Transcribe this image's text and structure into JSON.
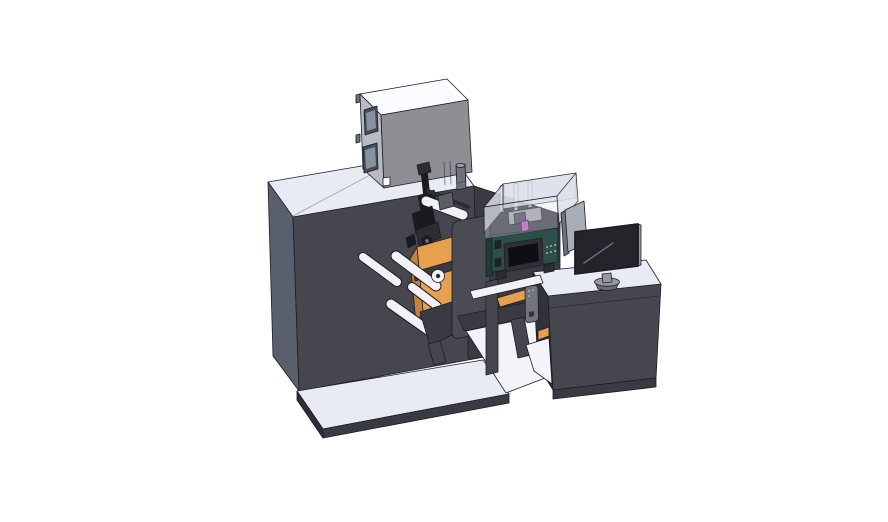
{
  "meta": {
    "alt": "Isometric 3D CAD rendering of an industrial roll-fed label printing machine: a large dark charcoal cabinet on a white base plate with a gray top enclosure box, an orange unwind arm with white guide rollers and black print mechanism, a dark front cover plate, a teal inkjet print module with a small touchscreen under a clear media enclosure, a transfer bridge, and an operator desk with a monitor on top.",
    "canvas": {
      "width": 888,
      "height": 522
    }
  },
  "colors": {
    "background": "#ffffff",
    "surface_light": "#e8eaf4",
    "floor_white": "#f3f4f9",
    "surface_white": "#fafbfe",
    "cabinet_front": "#46464e",
    "cabinet_side": "#5a5f6d",
    "cabinet_dark": "#3a3a42",
    "base_edge_dark": "#2e2e36",
    "desk_side": "#32323a",
    "box_front": "#8e8e93",
    "box_side": "#b8bbc3",
    "window_frame": "#454c59",
    "window_glass": "#8792a1",
    "plate_gray": "#4b4b53",
    "bracket_gray": "#71737d",
    "metal_mid": "#6e707a",
    "metal_light": "#9aa0ab",
    "roller_white": "#f2f2f6",
    "mech_black": "#1b1b1f",
    "mech_dark2": "#2c2c33",
    "mech_gray": "#5c5e66",
    "accent_orange": "#e6a04e",
    "accent_orange_dark": "#c2843c",
    "teal_front": "#2d4f49",
    "teal_dark": "#203b36",
    "screen_bezel": "#303036",
    "screen_black": "#0f0f13",
    "monitor_screen": "#24242a",
    "panel_gray": "#a8adb8",
    "panel_edge": "#6e727c",
    "stand_gray": "#97989f",
    "stand_dark": "#6b6d74",
    "acrylic": "#dde0eb",
    "magenta": "#c44fc4",
    "dot_light": "#ccd1d9",
    "reflect": "#838894",
    "outline": "#1d1d23"
  },
  "components": {
    "cabinet": "Main machine cabinet",
    "base_plate": "Machine base plate",
    "enclosure": "Top enclosure box",
    "mechanism": "Web path mechanism with guide rollers",
    "unwind": "Orange unwind arm",
    "cover_plate": "Front cover plate",
    "bridge": "Transfer bridge frame",
    "desk": "Operator desk",
    "inkjet": "Inkjet print module",
    "touchscreen": "Module touchscreen",
    "acrylic": "Clear media enclosure",
    "panel": "Display panel",
    "monitor": "Operator monitor"
  }
}
